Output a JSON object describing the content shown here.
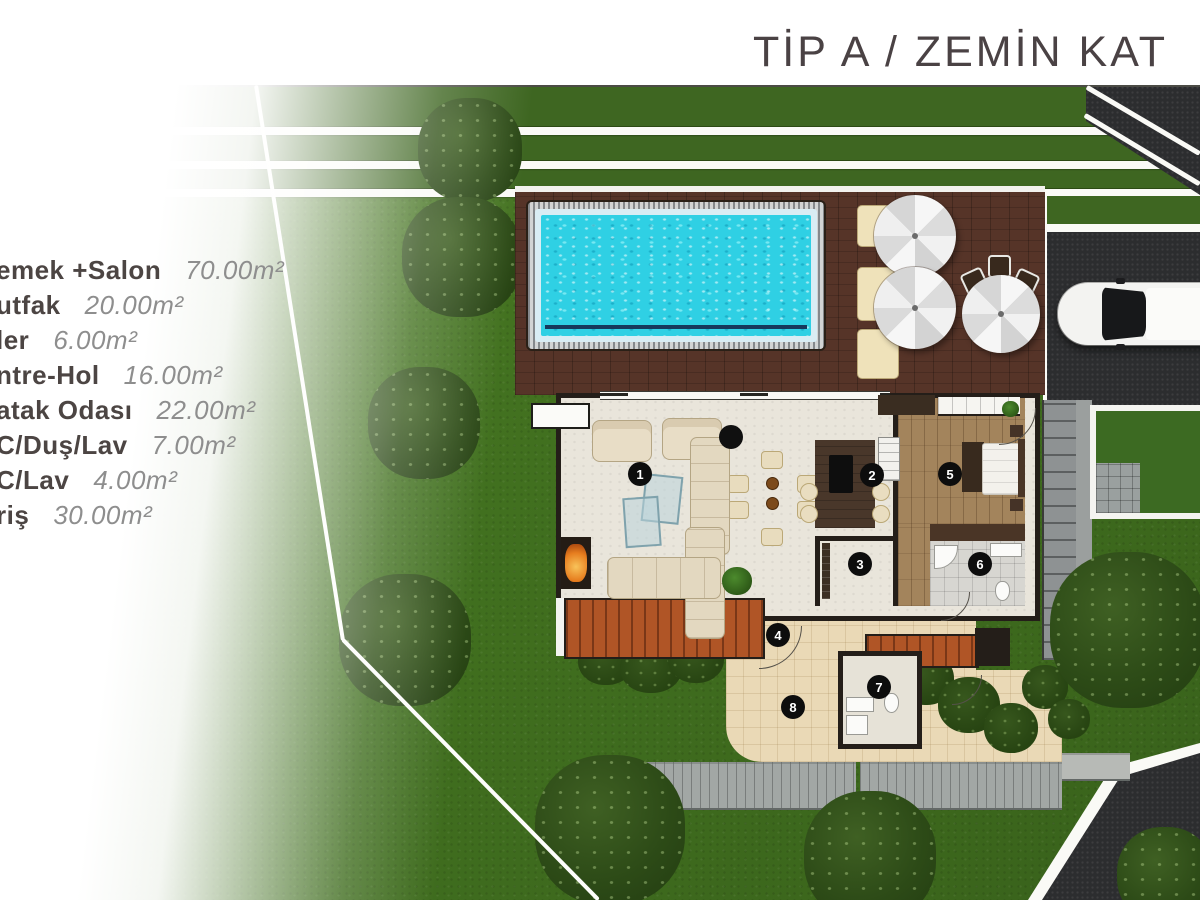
{
  "title": "TİP A / ZEMİN KAT",
  "legend": {
    "items": [
      {
        "name": "emek +Salon",
        "area": "70.00m²",
        "room": "yemek-salon"
      },
      {
        "name": "utfak",
        "area": "20.00m²",
        "room": "mutfak"
      },
      {
        "name": "ler",
        "area": "6.00m²",
        "room": "kiler"
      },
      {
        "name": "ntre-Hol",
        "area": "16.00m²",
        "room": "antre-hol"
      },
      {
        "name": "atak Odası",
        "area": "22.00m²",
        "room": "yatak-odasi"
      },
      {
        "name": "C/Duş/Lav",
        "area": "7.00m²",
        "room": "wc-dus-lav"
      },
      {
        "name": "C/Lav",
        "area": "4.00m²",
        "room": "wc-lav"
      },
      {
        "name": "riş",
        "area": "30.00m²",
        "room": "giris"
      }
    ]
  },
  "plan": {
    "markers": [
      {
        "number": "1",
        "room": "yemek-salon",
        "x": 640,
        "y": 389
      },
      {
        "number": "2",
        "room": "mutfak",
        "x": 872,
        "y": 390
      },
      {
        "number": "3",
        "room": "kiler",
        "x": 860,
        "y": 479
      },
      {
        "number": "4",
        "room": "antre-hol",
        "x": 778,
        "y": 550
      },
      {
        "number": "5",
        "room": "yatak-odasi",
        "x": 950,
        "y": 389
      },
      {
        "number": "6",
        "room": "wc-dus-lav",
        "x": 980,
        "y": 479
      },
      {
        "number": "7",
        "room": "wc-lav",
        "x": 879,
        "y": 602
      },
      {
        "number": "8",
        "room": "giris",
        "x": 793,
        "y": 622
      }
    ]
  },
  "colors": {
    "title_text": "#4a4244",
    "legend_name": "#4c4543",
    "legend_value": "#8e8e8e",
    "pool_water": "#2fd0e4",
    "pool_rim": "#d9edf4",
    "interior": "#e9e5db",
    "path": "#ead9b6",
    "marker_bg": "#0d0d0d"
  }
}
